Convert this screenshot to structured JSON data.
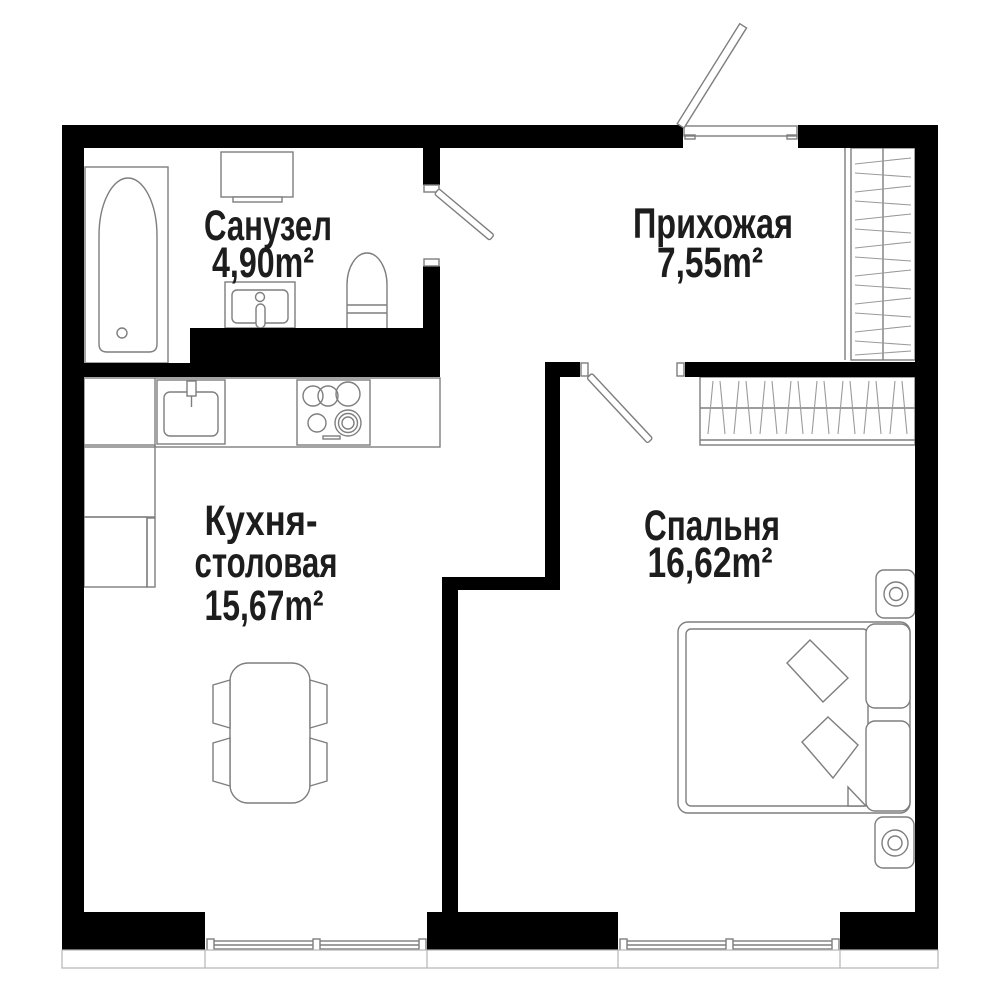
{
  "plan": {
    "type": "apartment-floor-plan",
    "rooms": [
      {
        "id": "bathroom",
        "name": "Санузел",
        "area": "4,90m²"
      },
      {
        "id": "hallway",
        "name": "Прихожая",
        "area": "7,55m²"
      },
      {
        "id": "kitchen",
        "name_line1": "Кухня-",
        "name_line2": "столовая",
        "area": "15,67m²"
      },
      {
        "id": "bedroom",
        "name": "Спальня",
        "area": "16,62m²"
      }
    ],
    "fixtures": [
      "bathtub",
      "washing-machine",
      "bathroom-sink",
      "toilet",
      "hallway-wardrobe",
      "bedroom-wardrobe",
      "kitchen-counter",
      "kitchen-sink",
      "stove",
      "fridge",
      "kitchen-cabinet",
      "dining-table",
      "chairs",
      "double-bed",
      "pillows",
      "cushions",
      "nightstands",
      "lamps",
      "entrance-door",
      "bathroom-door",
      "bedroom-door",
      "kitchen-window",
      "bedroom-window"
    ],
    "colors": {
      "wall": "#000000",
      "furniture": "#7e7e7e",
      "hatch": "#9a9a9a",
      "text": "#1d1d1d",
      "background": "#ffffff",
      "sill": "#b5b5b5"
    }
  }
}
